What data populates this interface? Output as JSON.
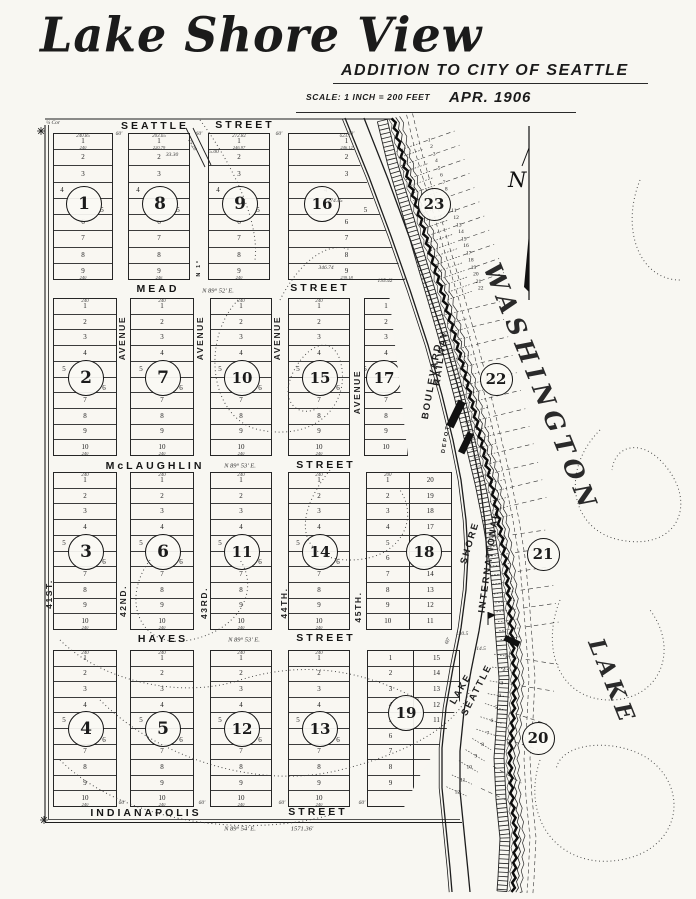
{
  "header": {
    "title": "Lake Shore View",
    "subtitle": "ADDITION  TO  CITY  OF  SEATTLE",
    "scale_note": "SCALE: 1 INCH = 200 FEET",
    "date": "APR. 1906"
  },
  "compass_label": "N",
  "map": {
    "streets": [
      {
        "text": "SEATTLE",
        "cx": 155,
        "cy": 126
      },
      {
        "text": "STREET",
        "cx": 245,
        "cy": 125
      },
      {
        "text": "MEAD",
        "cx": 158,
        "cy": 289
      },
      {
        "text": "STREET",
        "cx": 320,
        "cy": 288
      },
      {
        "text": "McLAUGHLIN",
        "cx": 155,
        "cy": 466
      },
      {
        "text": "STREET",
        "cx": 326,
        "cy": 465
      },
      {
        "text": "HAYES",
        "cx": 163,
        "cy": 639
      },
      {
        "text": "STREET",
        "cx": 326,
        "cy": 638
      },
      {
        "text": "INDIANAPOLIS",
        "cx": 146,
        "cy": 813
      },
      {
        "text": "STREET",
        "cx": 318,
        "cy": 812
      }
    ],
    "avenues": [
      {
        "text": "AVENUE",
        "cx": 122,
        "cy": 338,
        "rot": -90
      },
      {
        "text": "AVENUE",
        "cx": 200,
        "cy": 338,
        "rot": -90
      },
      {
        "text": "AVENUE",
        "cx": 277,
        "cy": 338,
        "rot": -90
      },
      {
        "text": "AVENUE",
        "cx": 357,
        "cy": 392,
        "rot": -90
      },
      {
        "text": "42ND.",
        "cx": 123,
        "cy": 601,
        "rot": -90
      },
      {
        "text": "43RD.",
        "cx": 204,
        "cy": 603,
        "rot": -90
      },
      {
        "text": "44TH.",
        "cx": 284,
        "cy": 603,
        "rot": -90
      },
      {
        "text": "45TH.",
        "cx": 358,
        "cy": 607,
        "rot": -90
      },
      {
        "text": "41ST.",
        "cx": 49,
        "cy": 594,
        "rot": -90
      },
      {
        "text": "N 1°",
        "cx": 199,
        "cy": 268,
        "rot": -90,
        "small": true
      }
    ],
    "bearings": [
      {
        "text": "N 89° 52' E.",
        "cx": 218,
        "cy": 291
      },
      {
        "text": "N 89° 53' E.",
        "cx": 240,
        "cy": 466
      },
      {
        "text": "N 89° 53' E.",
        "cx": 244,
        "cy": 640
      },
      {
        "text": "N 89° 54' E.",
        "cx": 240,
        "cy": 829
      },
      {
        "text": "1571.36'",
        "cx": 302,
        "cy": 829
      }
    ],
    "corridor_labels": [
      {
        "text": "BOULEVARD",
        "cx": 432,
        "cy": 381,
        "rot": -80
      },
      {
        "text": "RAILWAY",
        "cx": 441,
        "cy": 358,
        "rot": -82
      },
      {
        "text": "SHORE",
        "cx": 470,
        "cy": 543,
        "rot": -73
      },
      {
        "text": "INTERNATIONAL",
        "cx": 489,
        "cy": 562,
        "rot": -82
      },
      {
        "text": "LAKE",
        "cx": 461,
        "cy": 689,
        "rot": -60
      },
      {
        "text": "SEATTLE",
        "cx": 477,
        "cy": 690,
        "rot": -63
      },
      {
        "text": "DEPOT",
        "cx": 446,
        "cy": 439,
        "rot": -80,
        "small": true
      }
    ],
    "lake_labels": [
      {
        "text": "WASHINGTON",
        "cx": 541,
        "cy": 388,
        "rot": 68,
        "size": 25,
        "ls": 6
      },
      {
        "text": "LAKE",
        "cx": 612,
        "cy": 682,
        "rot": 68,
        "size": 23,
        "ls": 5
      }
    ],
    "dims": [
      {
        "text": "¼ Cor",
        "cx": 53,
        "cy": 123
      },
      {
        "text": "60'",
        "cx": 119,
        "cy": 134
      },
      {
        "text": "60'",
        "cx": 199,
        "cy": 134
      },
      {
        "text": "60'",
        "cx": 279,
        "cy": 134
      },
      {
        "text": "60'",
        "cx": 351,
        "cy": 134
      },
      {
        "text": "60'",
        "cx": 122,
        "cy": 803
      },
      {
        "text": "60'",
        "cx": 202,
        "cy": 803
      },
      {
        "text": "60'",
        "cx": 282,
        "cy": 803
      },
      {
        "text": "60'",
        "cx": 362,
        "cy": 803
      },
      {
        "text": "135.42",
        "cx": 385,
        "cy": 281
      },
      {
        "text": "130.5",
        "cx": 462,
        "cy": 634
      },
      {
        "text": "14.5",
        "cx": 481,
        "cy": 649
      },
      {
        "text": "33.30",
        "cx": 172,
        "cy": 155
      },
      {
        "text": "5.00",
        "cx": 214,
        "cy": 152
      },
      {
        "text": "25.20",
        "cx": 192,
        "cy": 145,
        "rot": 62
      },
      {
        "text": "274.45",
        "cx": 335,
        "cy": 201
      },
      {
        "text": "346.74",
        "cx": 326,
        "cy": 268
      },
      {
        "text": "60'",
        "cx": 448,
        "cy": 641,
        "rot": -65
      }
    ],
    "rows": [
      {
        "y": 133,
        "h": 147,
        "lots": [
          "1",
          "2",
          "3",
          "4",
          "5",
          "6",
          "7",
          "8",
          "9"
        ],
        "circle_between": [
          "4",
          "5"
        ],
        "circle_cy": 203,
        "blocks": [
          {
            "num": "1",
            "x": 53,
            "w": 60,
            "top": "240.85",
            "d1": "240",
            "dN": "240"
          },
          {
            "num": "8",
            "x": 128,
            "w": 62,
            "top": "203.65",
            "d1": "220.79",
            "dN": "246"
          },
          {
            "num": "9",
            "x": 208,
            "w": 62,
            "top": "272.82",
            "d1": "246.97",
            "dN": "240"
          },
          {
            "num": "16",
            "x": 288,
            "w": 117,
            "top": "623.73",
            "d1": "246.12",
            "dN": "239.18",
            "clip": "polygon(0 0,51% 0,100% 100%,0 100%)",
            "ccx": 33
          }
        ]
      },
      {
        "y": 298,
        "h": 158,
        "lots": [
          "1",
          "2",
          "3",
          "4",
          "5",
          "6",
          "7",
          "8",
          "9",
          "10"
        ],
        "circle_between": [
          "5",
          "6"
        ],
        "circle_cy": 377,
        "blocks": [
          {
            "num": "2",
            "x": 53,
            "w": 64,
            "top": "240",
            "dN": "240"
          },
          {
            "num": "7",
            "x": 130,
            "w": 64,
            "top": "240",
            "dN": "240"
          },
          {
            "num": "10",
            "x": 210,
            "w": 62,
            "top": "240",
            "dN": "240"
          },
          {
            "num": "15",
            "x": 288,
            "w": 62,
            "top": "240",
            "dN": "240"
          },
          {
            "num": "17",
            "x": 364,
            "w": 44,
            "clip": "polygon(0 0,58% 0,100% 100%,0 100%)",
            "ccx": 19
          }
        ]
      },
      {
        "y": 472,
        "h": 158,
        "lots": [
          "1",
          "2",
          "3",
          "4",
          "5",
          "6",
          "7",
          "8",
          "9",
          "10"
        ],
        "circle_between": [
          "5",
          "6"
        ],
        "circle_cy": 551,
        "blocks": [
          {
            "num": "3",
            "x": 53,
            "w": 64,
            "top": "240",
            "dN": "240"
          },
          {
            "num": "6",
            "x": 130,
            "w": 64,
            "top": "240",
            "dN": "240"
          },
          {
            "num": "11",
            "x": 210,
            "w": 62,
            "top": "240",
            "dN": "240"
          },
          {
            "num": "14",
            "x": 288,
            "w": 62,
            "top": "240",
            "dN": "240"
          },
          {
            "num": "18",
            "x": 366,
            "w": 86,
            "ccx": 57,
            "cols": [
              {
                "lots": [
                  "1",
                  "2",
                  "3",
                  "4",
                  "5",
                  "6",
                  "7",
                  "8",
                  "9",
                  "10"
                ],
                "top": "200"
              },
              {
                "lots": [
                  "20",
                  "19",
                  "18",
                  "17",
                  "16",
                  "15",
                  "14",
                  "13",
                  "12",
                  "11"
                ]
              }
            ]
          }
        ]
      },
      {
        "y": 650,
        "h": 157,
        "lots": [
          "1",
          "2",
          "3",
          "4",
          "5",
          "6",
          "7",
          "8",
          "9",
          "10"
        ],
        "circle_between": [
          "5",
          "6"
        ],
        "circle_cy": 728,
        "blocks": [
          {
            "num": "4",
            "x": 53,
            "w": 64,
            "top": "240",
            "dN": "240"
          },
          {
            "num": "5",
            "x": 130,
            "w": 64,
            "top": "240",
            "dN": "240"
          },
          {
            "num": "12",
            "x": 210,
            "w": 62,
            "top": "240",
            "dN": "240"
          },
          {
            "num": "13",
            "x": 288,
            "w": 62,
            "top": "240",
            "dN": "240"
          },
          {
            "num": "19",
            "x": 367,
            "w": 93,
            "ccx": 38,
            "ccy": 712,
            "clip": "polygon(0 0,100% 0,100% 32%,78% 60%,55% 82%,40% 100%,0 100%)",
            "cols": [
              {
                "lots": [
                  "1",
                  "2",
                  "3",
                  "4",
                  "5",
                  "6",
                  "7",
                  "8",
                  "9",
                  ""
                ]
              },
              {
                "lots": [
                  "15",
                  "14",
                  "13",
                  "12",
                  "11",
                  "",
                  "",
                  "",
                  "",
                  ""
                ]
              }
            ]
          }
        ]
      }
    ],
    "shore_blocks": [
      {
        "num": "23",
        "cx": 433,
        "cy": 203,
        "lot_numbers": [
          "1",
          "2",
          "3",
          "4",
          "5",
          "6",
          "7",
          "8",
          "9",
          "10",
          "11",
          "12",
          "13",
          "14",
          "15",
          "16",
          "17",
          "18",
          "19",
          "20",
          "21",
          "22"
        ]
      },
      {
        "num": "22",
        "cx": 495,
        "cy": 378,
        "lot_numbers": []
      },
      {
        "num": "21",
        "cx": 542,
        "cy": 553,
        "lot_numbers": []
      },
      {
        "num": "20",
        "cx": 537,
        "cy": 737,
        "lot_numbers": [
          "1",
          "2",
          "3",
          "4",
          "5",
          "6",
          "7",
          "8",
          "9",
          "10",
          "11",
          "12"
        ]
      }
    ]
  }
}
